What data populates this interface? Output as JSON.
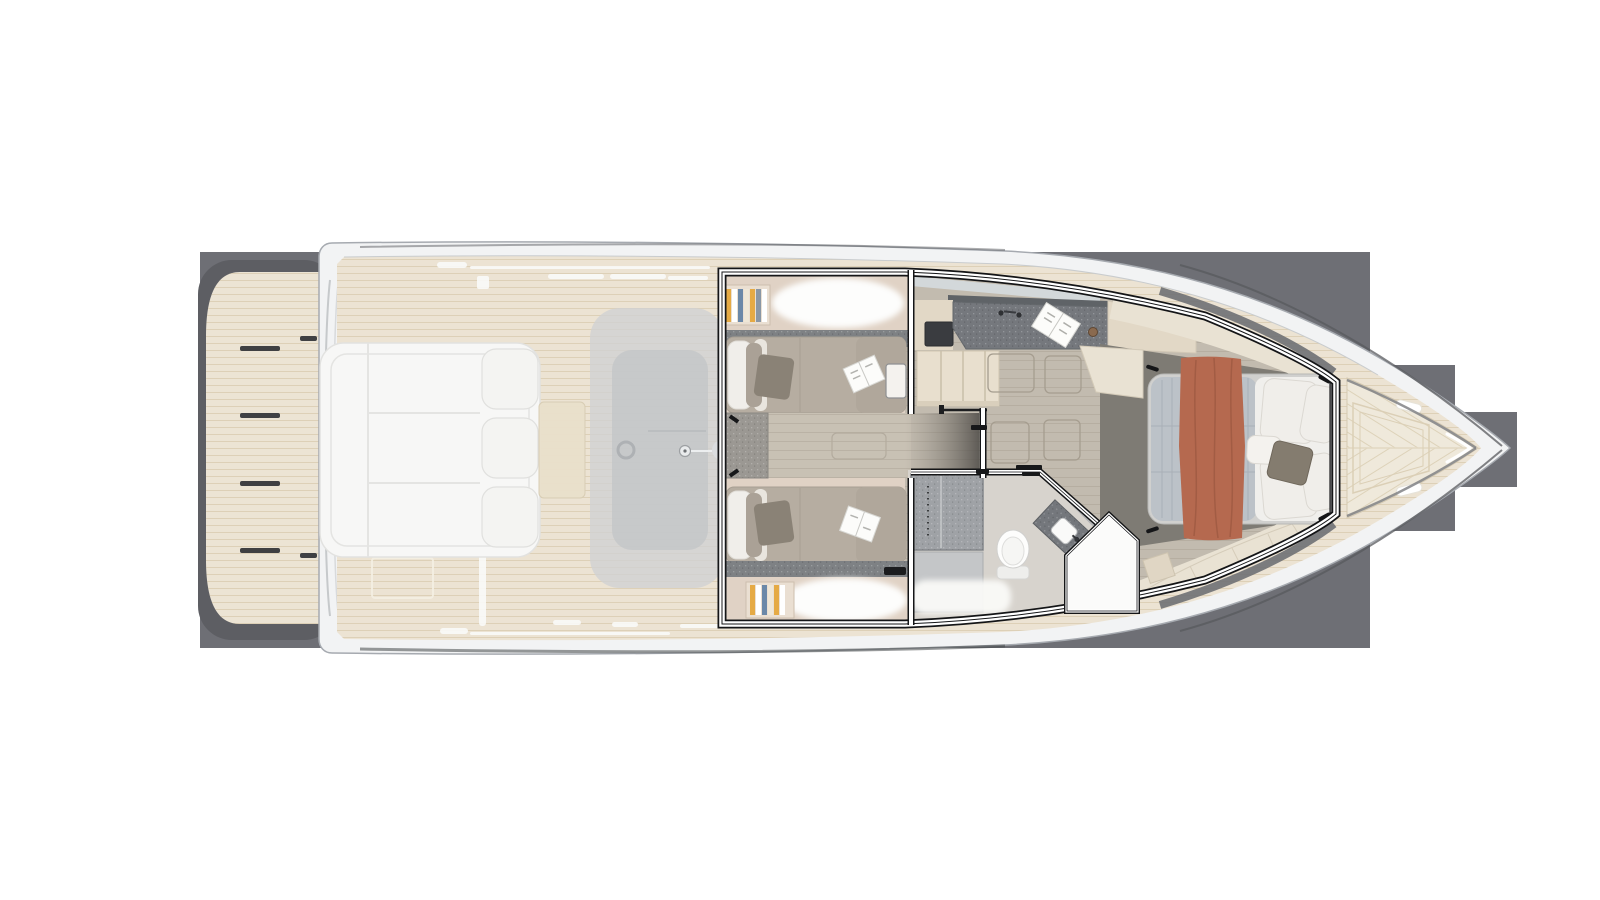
{
  "scene": {
    "type": "yacht-floorplan",
    "view": "top-down lower-deck cutaway render",
    "canvas": {
      "width": 1600,
      "height": 900
    }
  },
  "colors": {
    "page": "#ffffff",
    "backdrop": "#6e6f75",
    "backdropShadow": "#5d5e63",
    "hull": "#f2f3f4",
    "hullLine": "#a6aab0",
    "hullInnerLine": "#c9ccce",
    "rubTop": "#595b60",
    "rubBottom": "#46484b",
    "teak": "#ece3d3",
    "teakLine": "#cbb894",
    "platform": "#ece4d4",
    "stepDash": "#3f4043",
    "slotWhite": "#fafaf8",
    "ghostPad": "#f7f7f6",
    "ghostPadLine": "#e4e4e2",
    "ghostTable": "#e9dfca",
    "ghostModule": "#cfd1d3",
    "ghostModuleInner": "#c3c5c8",
    "ghostDetail": "#9da0a3",
    "wallBlack": "#141517",
    "wallWhite": "#ffffff",
    "cabinBase": "#e0d2c5",
    "wardrobe": "#7e8184",
    "duvet": "#b6ada1",
    "duvetDark": "#b0a79b",
    "pillowWhite": "#f0eeea",
    "pillowDark": "#8a8276",
    "bolster": "#aaa196",
    "magazine": "#fcfcfa",
    "carpet": "#9b9893",
    "corridor": "#c8c1b4",
    "bookYellow": "#e5aa45",
    "bookBlue": "#6b88a8",
    "bookSlate": "#8a97a5",
    "remoteBlack": "#1b1c1e",
    "salonFloor": "#c2bbaf",
    "hatchLine": "#a59d8f",
    "windshield": "#d5dbdf",
    "counter": "#75787d",
    "counterEdge": "#5f6367",
    "cabinet": "#e2d8c6",
    "appliance": "#3a3c40",
    "stairs": "#e8dfce",
    "stairSeam": "#c9bfa9",
    "railBlack": "#1d1e20",
    "voidDark": "#55524e",
    "bathFloor": "#d7d3cd",
    "shower": "#9fa2a6",
    "showerLow": "#c4c6c8",
    "toiletWhite": "#fdfdfc",
    "vanity": "#74777c",
    "masterFloor": "#7e7b74",
    "bench": "#e9e2d3",
    "benchLine": "#d5ccba",
    "mattressQuilt": "#bcc2c8",
    "quiltLine": "#a9b0b7",
    "sheet": "#f0efec",
    "throwRed": "#b5694f",
    "throwFold": "#9e5941",
    "bulkhead": "#8a8c8f",
    "bowDeck": "#efe9db",
    "bowLine": "#dbcfb6",
    "cleatWhite": "#ffffff",
    "bowEdgeDark": "#797a7e",
    "knobBronze": "#8a6a4f"
  },
  "areas": [
    {
      "id": "swim-platform",
      "label": "swim platform",
      "features": [
        "teak planking",
        "four step treads"
      ]
    },
    {
      "id": "aft-deck-ghost",
      "label": "aft cockpit (upper deck, ghosted)",
      "features": [
        "large sunpad with three backrest cushions",
        "side table",
        "cockpit console with ring and sink fittings"
      ]
    },
    {
      "id": "guest-cabin",
      "label": "twin guest cabin",
      "features": [
        "two single berths",
        "white and taupe pillows",
        "open magazines",
        "carpeted nightstand",
        "wardrobe bands",
        "book shelves",
        "white bedding niches"
      ]
    },
    {
      "id": "corridor",
      "label": "corridor between berths",
      "features": [
        "wood plank floor",
        "floor hatch",
        "sliding door"
      ]
    },
    {
      "id": "galley-salon",
      "label": "galley and salon",
      "features": [
        "speckled countertop with faucet",
        "open cookbook",
        "dark appliance",
        "companionway stairs with handrail",
        "storage floor hatches",
        "windshield strip"
      ]
    },
    {
      "id": "bathroom",
      "label": "head / bathroom",
      "features": [
        "shower cabin with glass door",
        "toilet",
        "angled vanity with sink",
        "angled pentagon door",
        "white bath mat"
      ]
    },
    {
      "id": "master-cabin",
      "label": "forward master cabin",
      "features": [
        "double bed",
        "blue-grey quilt",
        "terracotta throw blanket",
        "white pillows",
        "dark taupe pillow",
        "wrap-around cream benches",
        "dark floor walkway",
        "bow bulkhead"
      ]
    },
    {
      "id": "bow-deck",
      "label": "bow deck",
      "features": [
        "chevron teak planks",
        "trapezoid deck hatch",
        "two white cleats"
      ]
    }
  ]
}
